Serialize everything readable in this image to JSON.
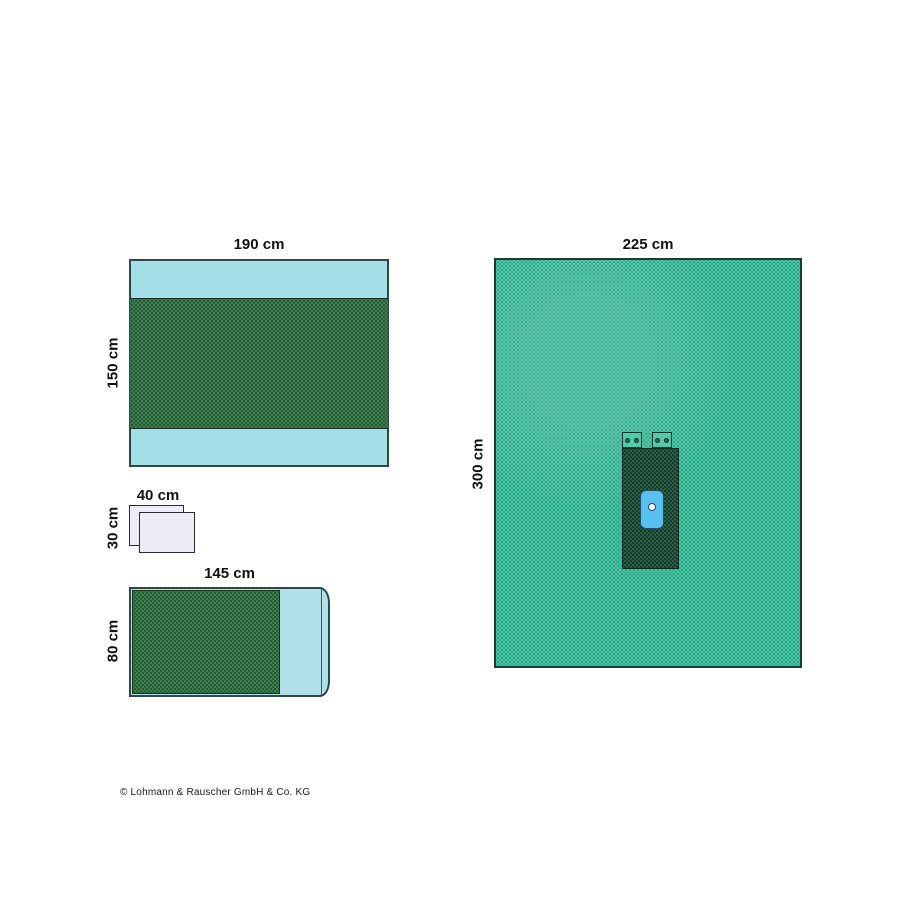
{
  "illustration": {
    "drape_adhesive": {
      "width_label": "190 cm",
      "height_label": "150 cm"
    },
    "towels": {
      "width_label": "40 cm",
      "height_label": "30 cm"
    },
    "drape_side": {
      "width_label": "145 cm",
      "height_label": "80 cm"
    },
    "drape_main": {
      "width_label": "225 cm",
      "height_label": "300 cm",
      "aperture_label": "OP-Ausschnitt 4 cm"
    }
  },
  "footer": {
    "copyright": "© Lohmann & Rauscher GmbH & Co. KG"
  },
  "colors": {
    "light_cyan": "#a6dee8",
    "fabric_green": "#3e8051",
    "mint_green": "#48c8a6",
    "dark_green": "#2b5e45",
    "incise_blue": "#58c1ef",
    "towel_white": "#edecf4"
  }
}
